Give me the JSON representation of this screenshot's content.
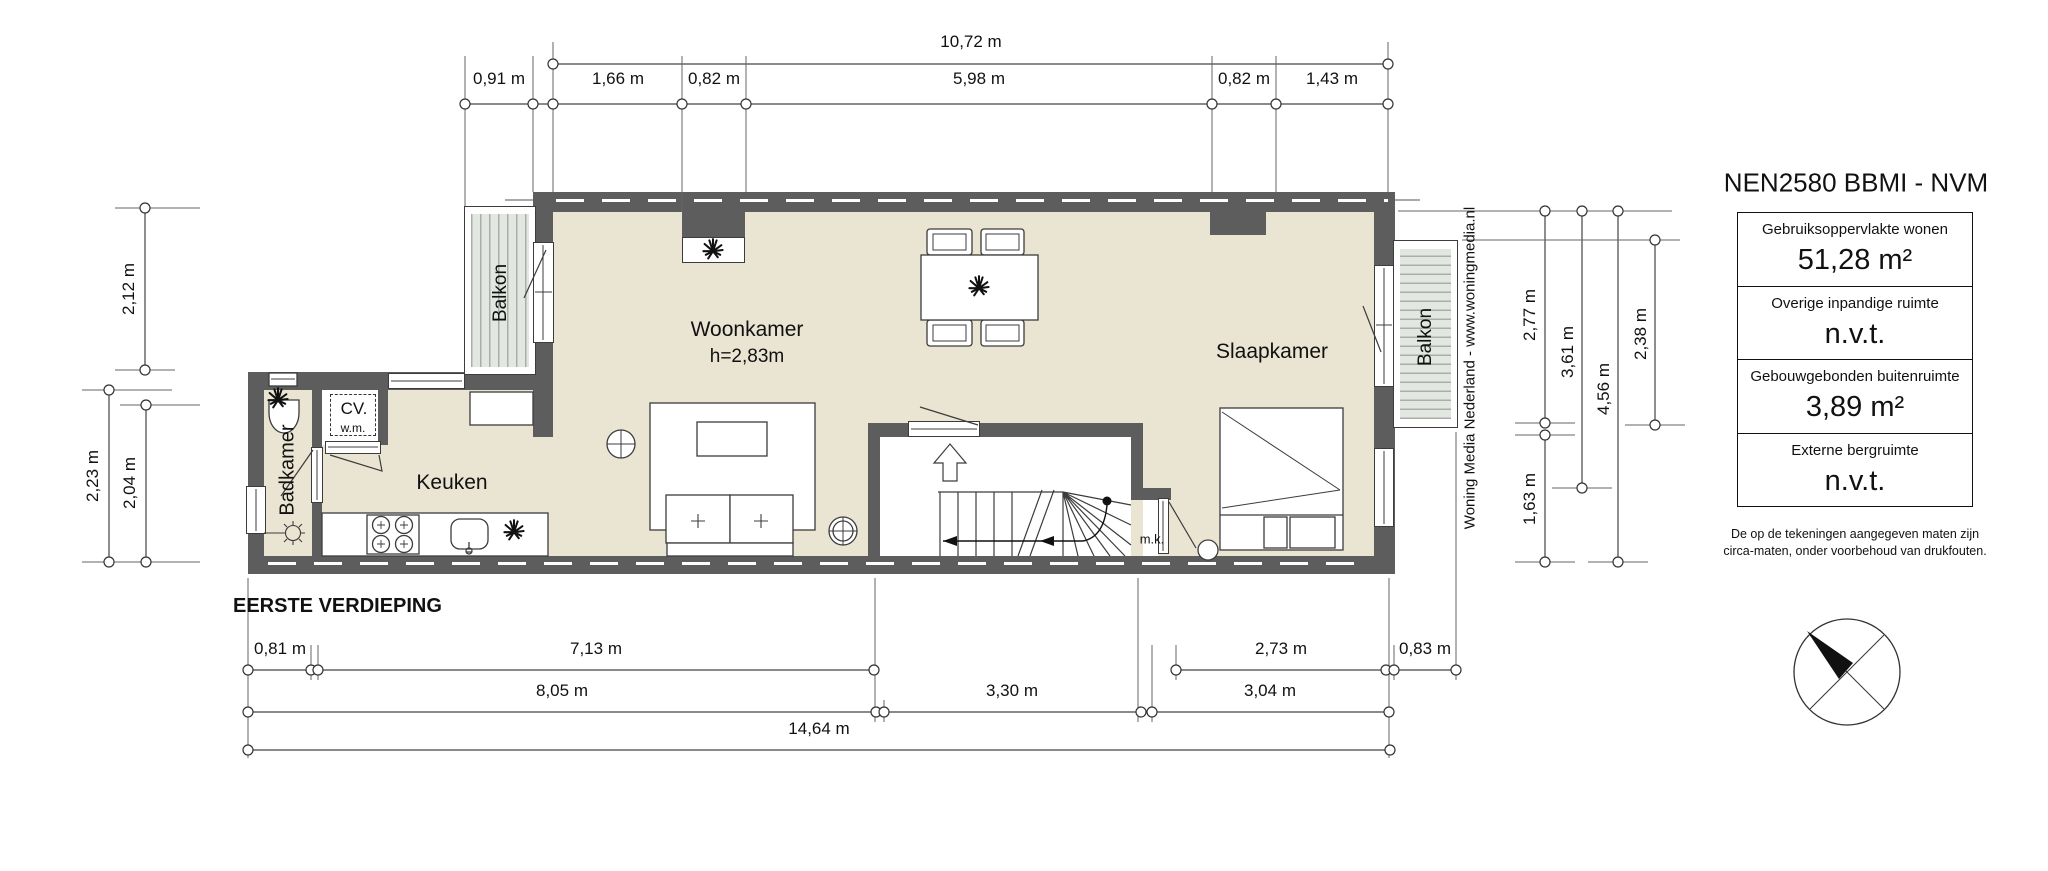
{
  "plan_title": "EERSTE VERDIEPING",
  "credit": "Woning Media Nederland - www.woningmedia.nl",
  "legend": {
    "title": "NEN2580 BBMI - NVM",
    "rows": [
      {
        "label": "Gebruiksoppervlakte wonen",
        "value": "51,28 m²"
      },
      {
        "label": "Overige inpandige ruimte",
        "value": "n.v.t."
      },
      {
        "label": "Gebouwgebonden buitenruimte",
        "value": "3,89 m²"
      },
      {
        "label": "Externe bergruimte",
        "value": "n.v.t."
      }
    ],
    "disclaimer_line1": "De op de tekeningen aangegeven maten zijn",
    "disclaimer_line2": "circa-maten, onder voorbehoud van drukfouten."
  },
  "rooms": {
    "woonkamer": "Woonkamer",
    "woonkamer_height": "h=2,83m",
    "slaapkamer": "Slaapkamer",
    "keuken": "Keuken",
    "badkamer": "Badkamer",
    "balkon_left": "Balkon",
    "balkon_right": "Balkon",
    "cv": "CV.",
    "wm": "w.m.",
    "mk": "m.k."
  },
  "dimensions": {
    "top_total": "10,72 m",
    "top_segments": [
      "0,91 m",
      "1,66 m",
      "0,82 m",
      "5,98 m",
      "0,82 m",
      "1,43 m"
    ],
    "left": [
      "2,12 m",
      "2,23 m",
      "2,04 m"
    ],
    "right": [
      "2,77 m",
      "3,61 m",
      "4,56 m",
      "2,38 m",
      "1,63 m"
    ],
    "bottom_row1": [
      "0,81 m",
      "7,13 m",
      "2,73 m",
      "0,83 m"
    ],
    "bottom_row2": [
      "8,05 m",
      "3,30 m",
      "3,04 m"
    ],
    "bottom_total": "14,64 m"
  }
}
